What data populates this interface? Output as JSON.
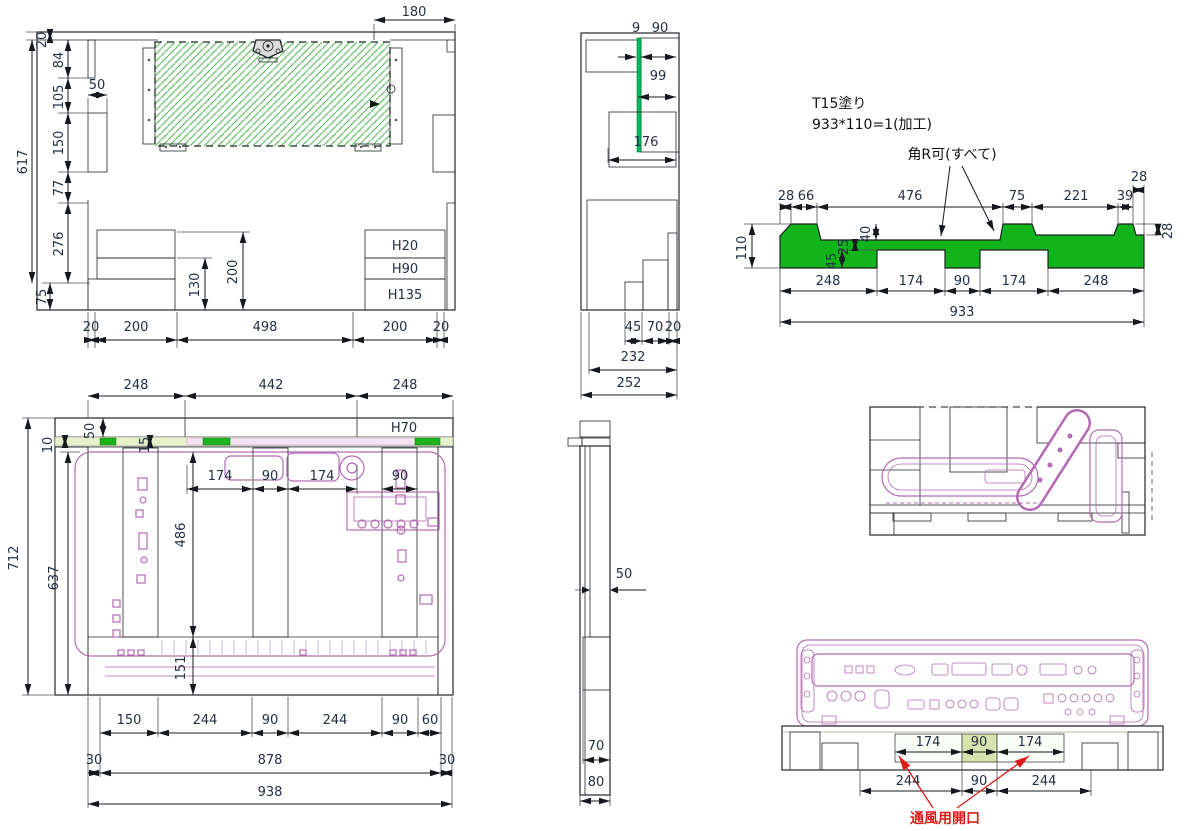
{
  "colors": {
    "green": "#12b41c",
    "hatch_green": "#62c463",
    "light_green": "#e7f2cd",
    "pallet_green": "#f1f6e3",
    "pink": "#b56ab5",
    "red": "#e01818",
    "gray_dark": "#b5b5b5",
    "gray_mid": "#c9c9c9",
    "gray_light": "#ececec"
  },
  "notes": {
    "paint1": "T15塗り",
    "paint2": "933*110=1(加工)",
    "corner_r": "角R可(すべて)",
    "vent": "通風用開口"
  },
  "tl": {
    "d180": "180",
    "d20": "20",
    "d84": "84",
    "d50": "50",
    "d105": "105",
    "d150": "150",
    "d617": "617",
    "d77": "77",
    "d276": "276",
    "d75": "75",
    "d200": "200",
    "d130": "130",
    "h20": "H20",
    "h90": "H90",
    "h135": "H135",
    "b20a": "20",
    "b200a": "200",
    "b498": "498",
    "b200b": "200",
    "b20b": "20"
  },
  "tm": {
    "d9": "9",
    "d90": "90",
    "d99": "99",
    "d176": "176",
    "d45": "45",
    "d70": "70",
    "d20": "20",
    "d232": "232",
    "d252": "252"
  },
  "tr": {
    "t28a": "28",
    "t66": "66",
    "t476": "476",
    "t75": "75",
    "t221": "221",
    "t39": "39",
    "t28b": "28",
    "d110": "110",
    "d40": "40",
    "d25": "25",
    "d45": "45",
    "r28": "28",
    "b248a": "248",
    "b174a": "174",
    "b90": "90",
    "b174b": "174",
    "b248b": "248",
    "b933": "933"
  },
  "bl": {
    "t248a": "248",
    "t442": "442",
    "t248b": "248",
    "h70": "H70",
    "d50": "50",
    "d15": "15",
    "d10": "10",
    "m174a": "174",
    "m90a": "90",
    "m174b": "174",
    "m90b": "90",
    "d486": "486",
    "d712": "712",
    "d637": "637",
    "d151": "151",
    "b150": "150",
    "b244a": "244",
    "b90a": "90",
    "b244b": "244",
    "b90b": "90",
    "b60": "60",
    "b30a": "30",
    "b878": "878",
    "b30b": "30",
    "b938": "938"
  },
  "bm": {
    "d50": "50",
    "d70": "70",
    "d80": "80"
  },
  "br": {
    "t174a": "174",
    "t90": "90",
    "t174b": "174",
    "b244a": "244",
    "b90": "90",
    "b244b": "244"
  }
}
